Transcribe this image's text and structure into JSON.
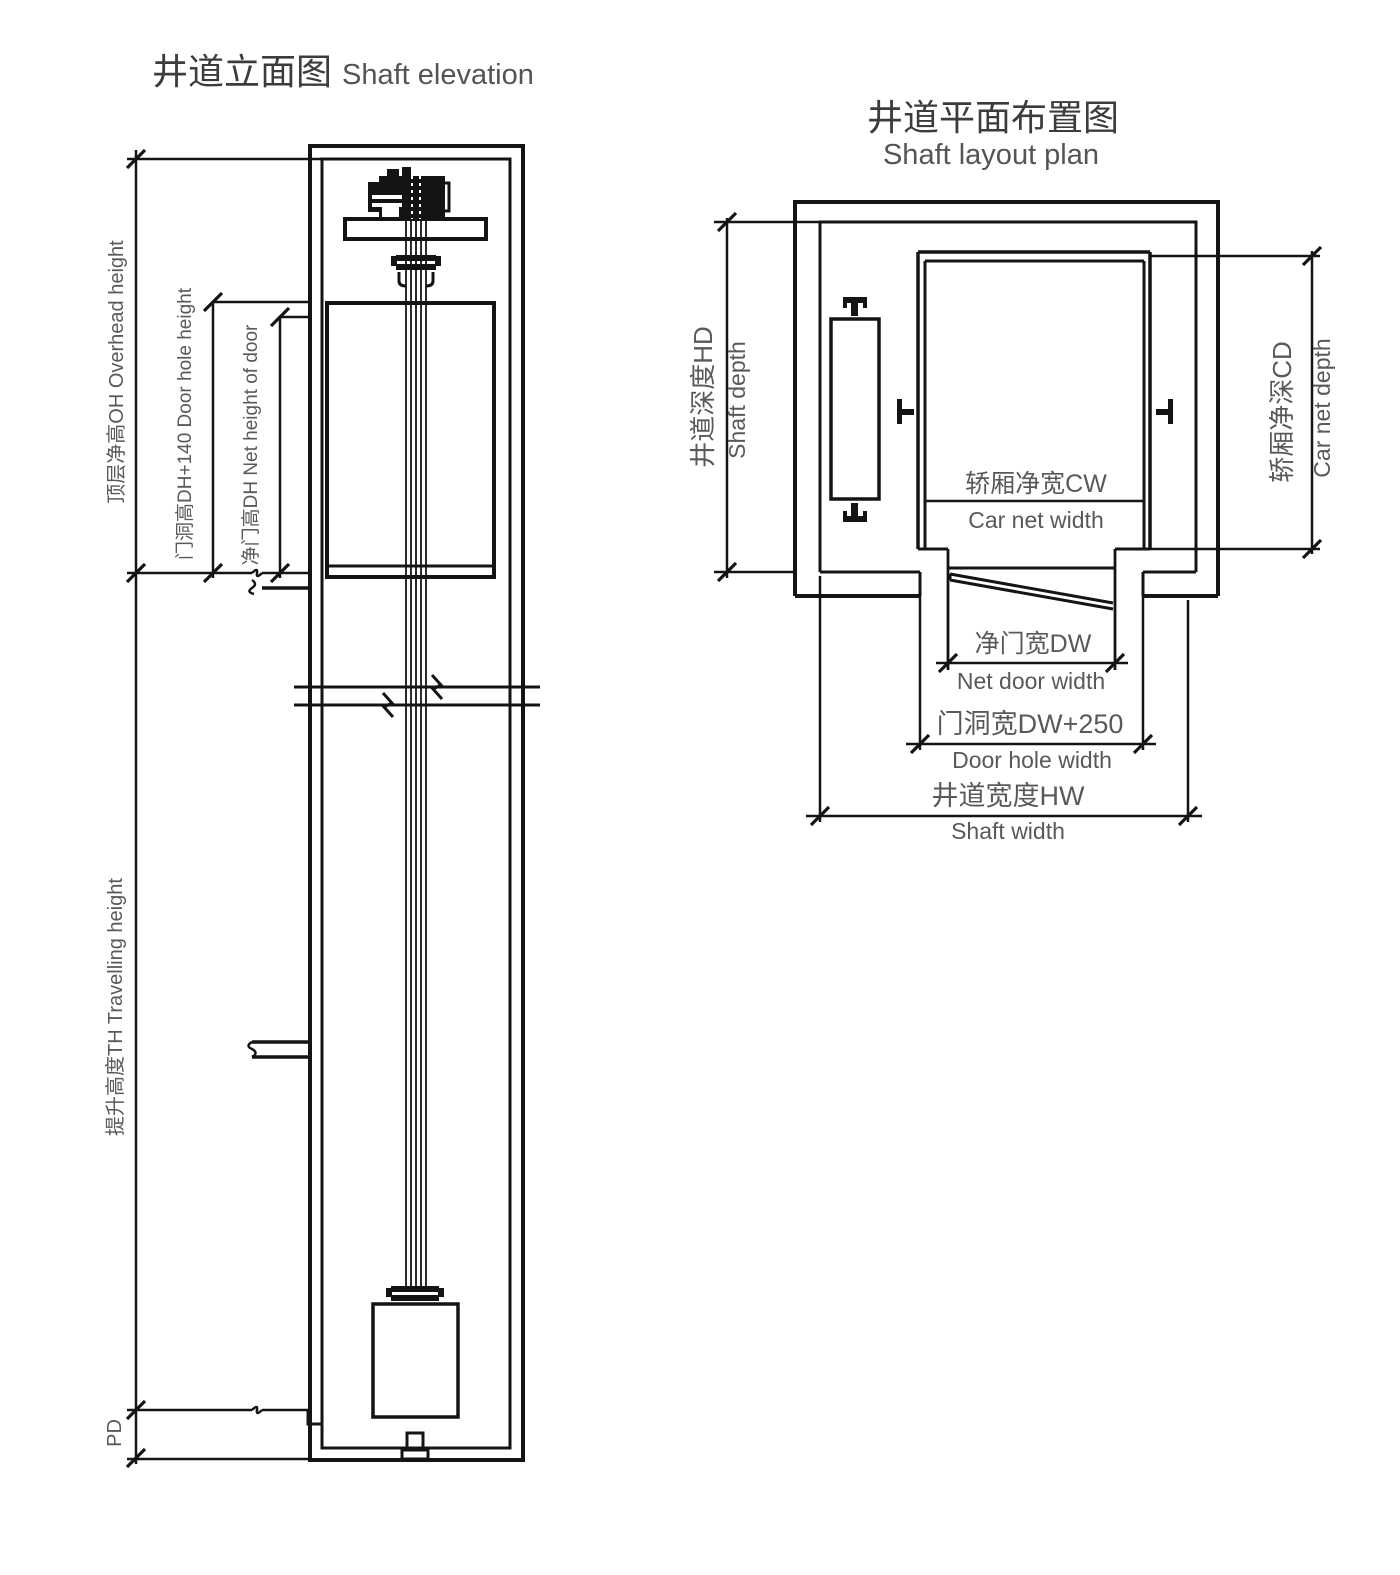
{
  "drawing_title": "Elevator shaft technical drawing",
  "elevation": {
    "title_cn": "井道立面图",
    "title_en": "Shaft elevation",
    "labels": {
      "overhead": "顶层净高OH  Overhead height",
      "door_hole": "门洞高DH+140  Door hole height",
      "net_door": "净门高DH  Net height of door",
      "travelling": "提升高度TH  Travelling height",
      "pit_depth": "PD"
    }
  },
  "plan": {
    "title_cn": "井道平面布置图",
    "title_en": "Shaft layout plan",
    "labels": {
      "shaft_depth_cn": "井道深度HD",
      "shaft_depth_en": "Shaft depth",
      "car_net_depth_cn": "轿厢净深CD",
      "car_net_depth_en": "Car net depth",
      "car_net_width_cn": "轿厢净宽CW",
      "car_net_width_en": "Car net width",
      "net_door_width_cn": "净门宽DW",
      "net_door_width_en": "Net door width",
      "door_hole_width_cn": "门洞宽DW+250",
      "door_hole_width_en": "Door hole width",
      "shaft_width_cn": "井道宽度HW",
      "shaft_width_en": "Shaft width"
    }
  },
  "colors": {
    "line": "#141414",
    "label": "#595959",
    "title_cn": "#3c3c3c",
    "title_en": "#555555",
    "background": "#ffffff"
  }
}
